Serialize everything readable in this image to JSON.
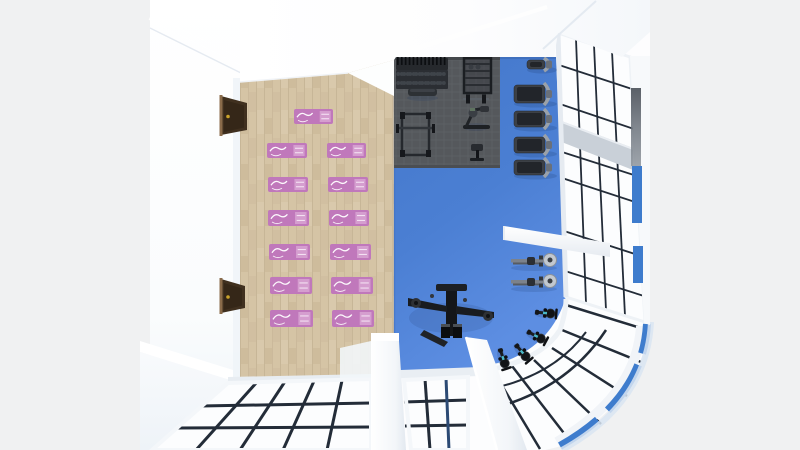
{
  "scene": {
    "name": "gym-3d-top-down-render",
    "description": "Top-down 3D render of a gym: wooden yoga area with pink mats (left), blue gym floor with equipment (right), glass window walls with rounded corner (bottom-right)",
    "areas": {
      "yoga_area": {
        "floor": "light wood planks",
        "mat_count": 13
      },
      "gym_area": {
        "floor": "blue",
        "rubber_mat": "dark gray grid mat"
      }
    }
  },
  "colors": {
    "background": "#f0f1f2",
    "building_base": "#fdfdfe",
    "wood_floor": "#d2c0a1",
    "wood_seam": "#c2b091",
    "blue_floor": "#4b7fd3",
    "blue_floor_light": "#5d8ee2",
    "rubber_mat": "#55585c",
    "rubber_mat_line": "#5e6266",
    "yoga_mat_pink": "#c078bb",
    "yoga_mat_pattern": "#d9a8d4",
    "exterior_blue": "#3e7ccd",
    "sky_tint": "#dce8f3",
    "glass": "#fcfdfe",
    "mullion_dark": "#232c38",
    "frame_light": "#eef2f6",
    "equipment_dark": "#1c1f23",
    "equipment_mid": "#33373c",
    "equipment_light": "#9aa1a9",
    "door_brown": "#40301f",
    "door_knob_gold": "#c9a22b",
    "bike_accent": "#49b8c8"
  },
  "yoga_mats": [
    [
      294,
      109,
      39,
      15
    ],
    [
      267,
      143,
      40,
      15
    ],
    [
      327,
      143,
      39,
      15
    ],
    [
      268,
      177,
      40,
      15
    ],
    [
      328,
      177,
      40,
      15
    ],
    [
      268,
      210,
      41,
      16
    ],
    [
      329,
      210,
      40,
      16
    ],
    [
      269,
      244,
      41,
      16
    ],
    [
      330,
      244,
      41,
      16
    ],
    [
      270,
      277,
      42,
      17
    ],
    [
      331,
      277,
      42,
      17
    ],
    [
      270,
      310,
      43,
      17
    ],
    [
      332,
      310,
      42,
      17
    ]
  ],
  "treadmills": [
    [
      527,
      58,
      30,
      13
    ],
    [
      514,
      83,
      43,
      22
    ],
    [
      514,
      109,
      43,
      20
    ],
    [
      514,
      135,
      43,
      20
    ],
    [
      514,
      158,
      43,
      19
    ]
  ],
  "rowers": [
    [
      511,
      253,
      46,
      15
    ],
    [
      511,
      274,
      46,
      15
    ]
  ],
  "bikes": [
    [
      545,
      313,
      5
    ],
    [
      536,
      336,
      28
    ],
    [
      522,
      352,
      50
    ],
    [
      503,
      358,
      72
    ]
  ],
  "stations": [
    {
      "type": "dumbbell-rack",
      "x": 396,
      "y": 57,
      "w": 52,
      "h": 33
    },
    {
      "type": "storage-rack",
      "x": 463,
      "y": 57,
      "w": 30,
      "h": 37
    },
    {
      "type": "flat-bench",
      "x": 407,
      "y": 87,
      "w": 31,
      "h": 11
    },
    {
      "type": "barbell",
      "x": 462,
      "y": 94,
      "w": 28,
      "h": 10
    },
    {
      "type": "power-cage",
      "x": 400,
      "y": 111,
      "w": 31,
      "h": 47
    },
    {
      "type": "seated-machine",
      "x": 462,
      "y": 105,
      "w": 29,
      "h": 26
    },
    {
      "type": "preacher-bench",
      "x": 469,
      "y": 142,
      "w": 17,
      "h": 18
    },
    {
      "type": "cable-crossover",
      "x": 405,
      "y": 282,
      "w": 92,
      "h": 64
    }
  ],
  "doors": [
    {
      "x": 221,
      "y": 96,
      "w": 26,
      "h": 39
    },
    {
      "x": 221,
      "y": 279,
      "w": 24,
      "h": 34
    }
  ]
}
